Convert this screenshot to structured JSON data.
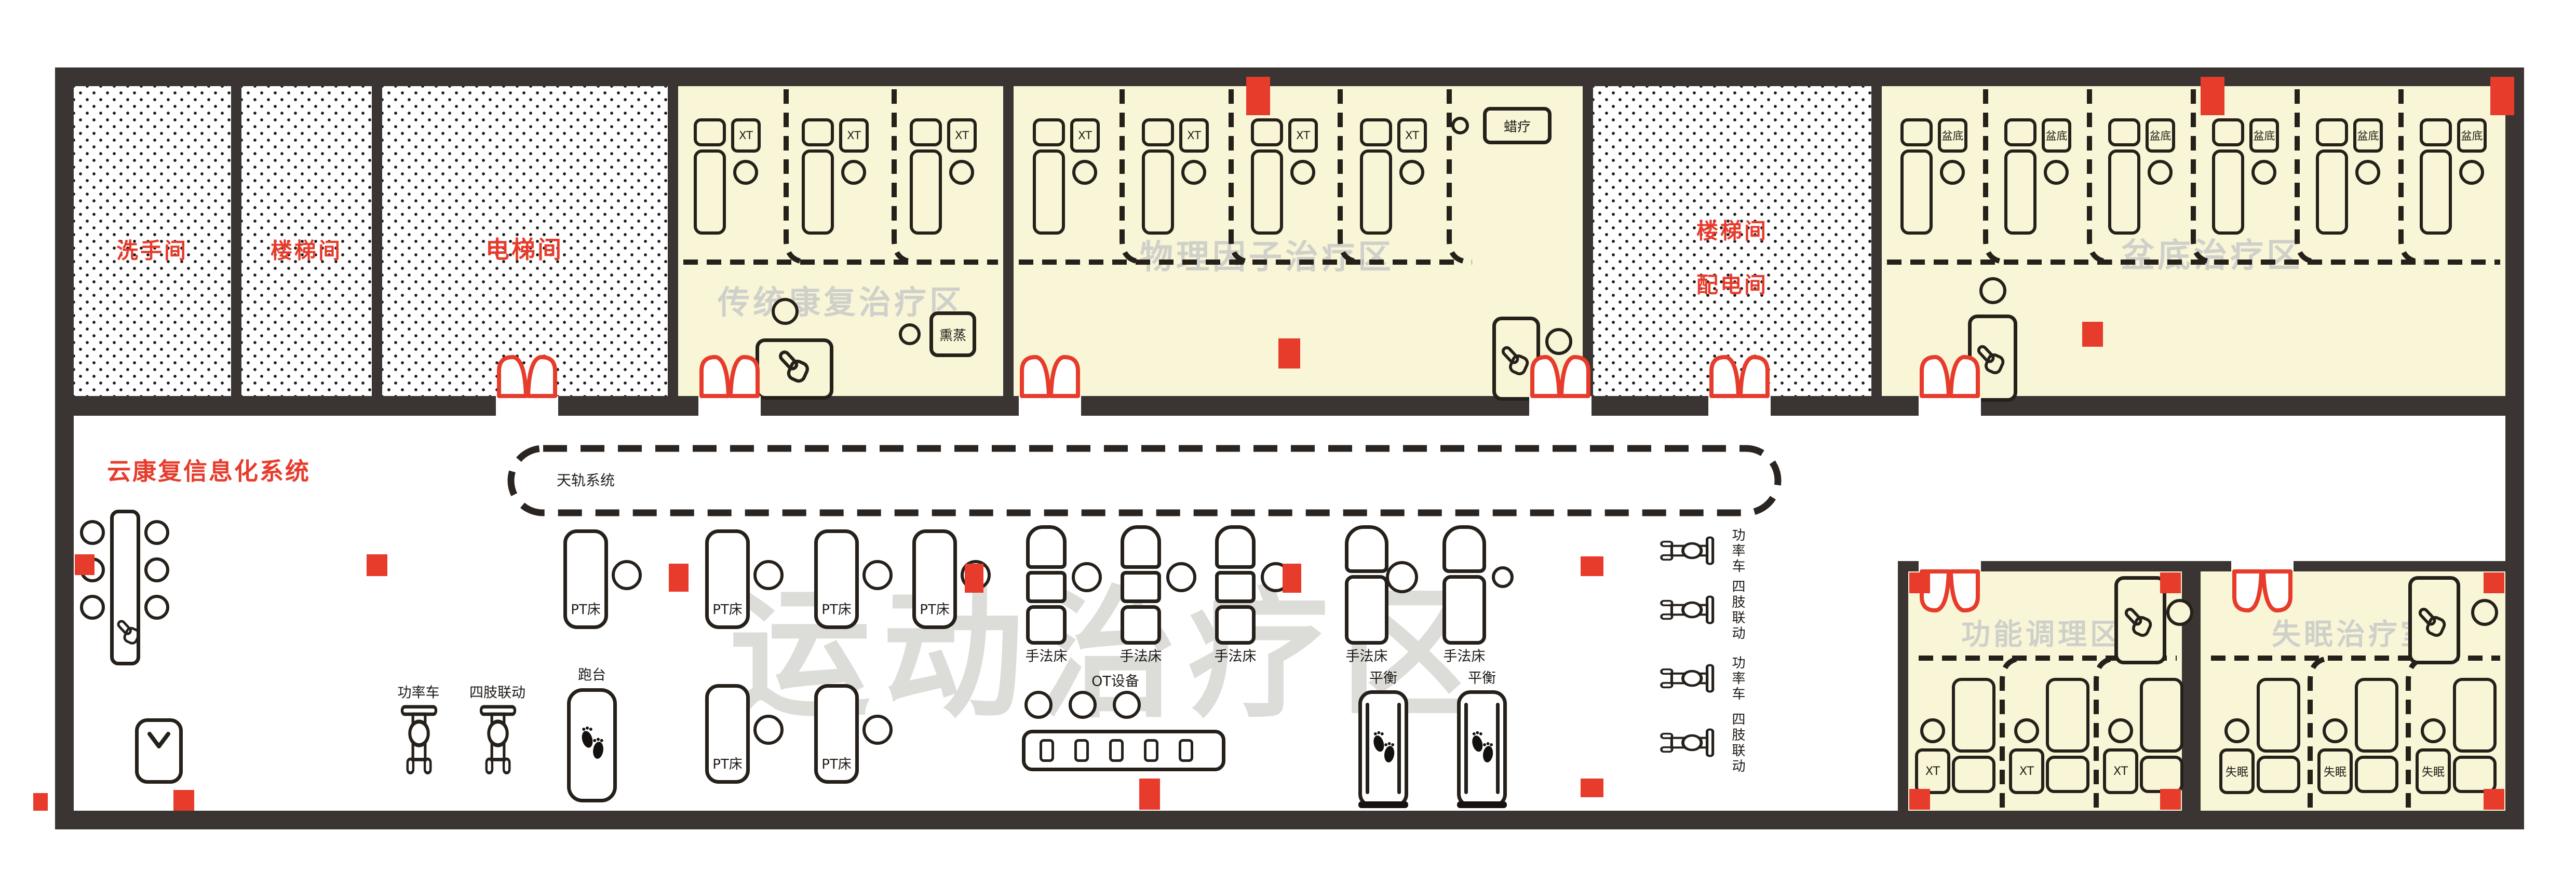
{
  "colors": {
    "wall": "#3a3532",
    "room_fill": "#f8f6d6",
    "accent_red": "#e73b2c",
    "line": "#26201b",
    "watermark": "#d0d0cb",
    "watermark_big": "#dcdcd8",
    "text": "#1e1a16"
  },
  "title": {
    "system_name": "云康复信息化系统"
  },
  "ceiling_track": {
    "label": "天轨系统"
  },
  "rooms": {
    "washroom": {
      "name": "洗手间"
    },
    "stairwell": {
      "name": "楼梯间"
    },
    "elevator": {
      "name": "电梯间"
    },
    "stair_power": {
      "line1": "楼梯间",
      "line2": "配电间"
    },
    "traditional_rehab": {
      "watermark": "传统康复治疗区",
      "device_label": "XT",
      "extra_label": "熏蒸",
      "bed_count": 3
    },
    "physical_factor": {
      "watermark": "物理因子治疗区",
      "device_label": "XT",
      "extra_label": "蜡疗",
      "bed_count": 4
    },
    "pelvic_floor": {
      "watermark": "盆底治疗区",
      "device_label": "盆底",
      "bed_count": 6
    },
    "exercise": {
      "watermark": "运动治疗区"
    },
    "function_conditioning": {
      "watermark": "功能调理区",
      "device_label": "XT",
      "bed_count": 3
    },
    "insomnia": {
      "watermark": "失眠治疗室",
      "device_label": "失眠",
      "bed_count": 3
    }
  },
  "equipment_labels": {
    "pt_bed": "PT床",
    "manual_bed": "手法床",
    "ot_device": "OT设备",
    "treadmill": "跑台",
    "balance": "平衡",
    "power_bike": "功率车",
    "limb_linkage": "四肢联动"
  }
}
